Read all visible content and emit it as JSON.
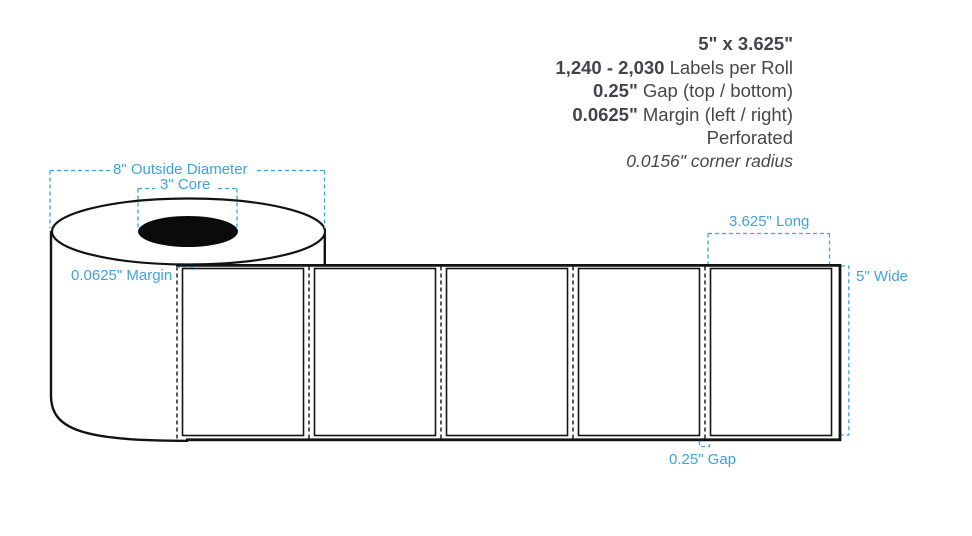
{
  "specs": {
    "size": "5\" x 3.625\"",
    "labels_per_roll": {
      "value": "1,240 - 2,030",
      "label": " Labels per Roll"
    },
    "gap": {
      "value": "0.25\"",
      "label": " Gap (top / bottom)"
    },
    "margin": {
      "value": "0.0625\"",
      "label": " Margin (left / right)"
    },
    "finish": "Perforated",
    "corner_radius": "0.0156\" corner radius"
  },
  "roll_diagram": {
    "outside_diameter_label": "8\" Outside Diameter",
    "core_label": "3\" Core",
    "margin_label": "0.0625\" Margin",
    "length_label": "3.625\" Long",
    "width_label": "5\" Wide",
    "gap_label": "0.25\" Gap",
    "label_count": 5,
    "colors": {
      "annotation_blue": "#3FA2D9",
      "outline_black": "#131313",
      "spec_text_gray": "#46474B",
      "core_fill": "#0B0B0B"
    }
  }
}
